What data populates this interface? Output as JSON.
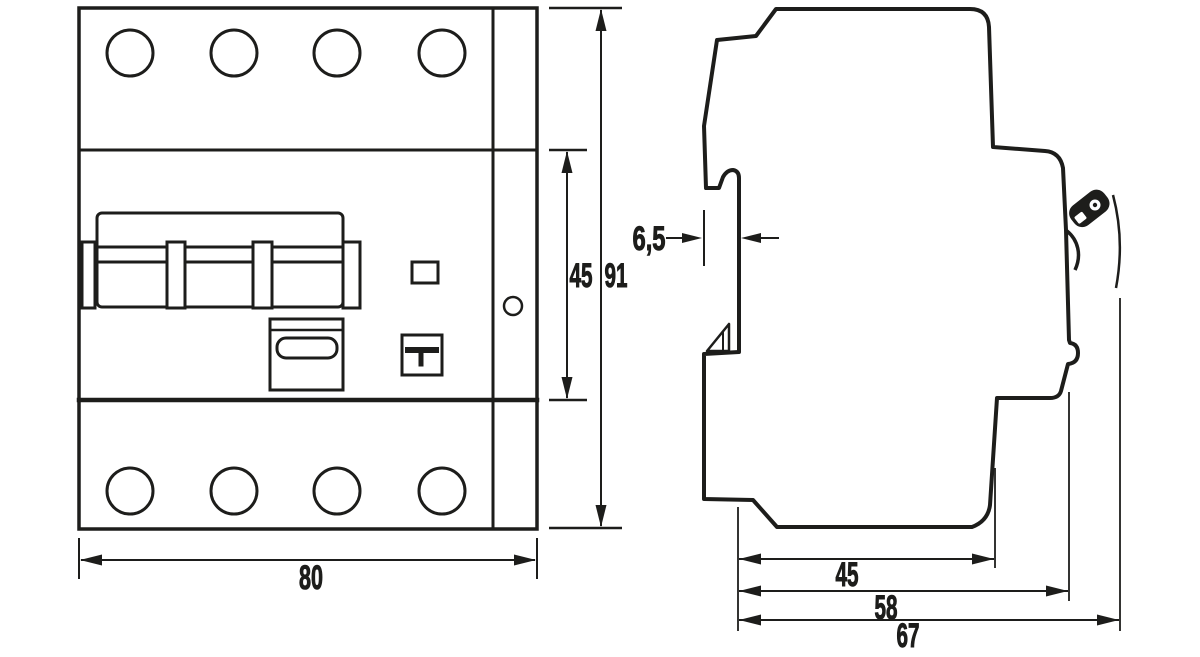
{
  "drawing": {
    "colors": {
      "ink": "#1d1d1b",
      "paper": "#ffffff"
    },
    "front_view": {
      "width_mm": "80",
      "height_module_mm": "45",
      "height_total_mm": "91"
    },
    "side_view": {
      "rail_recess_mm": "6,5",
      "depth_base_mm": "45",
      "depth_body_mm": "58",
      "depth_total_mm": "67"
    }
  }
}
